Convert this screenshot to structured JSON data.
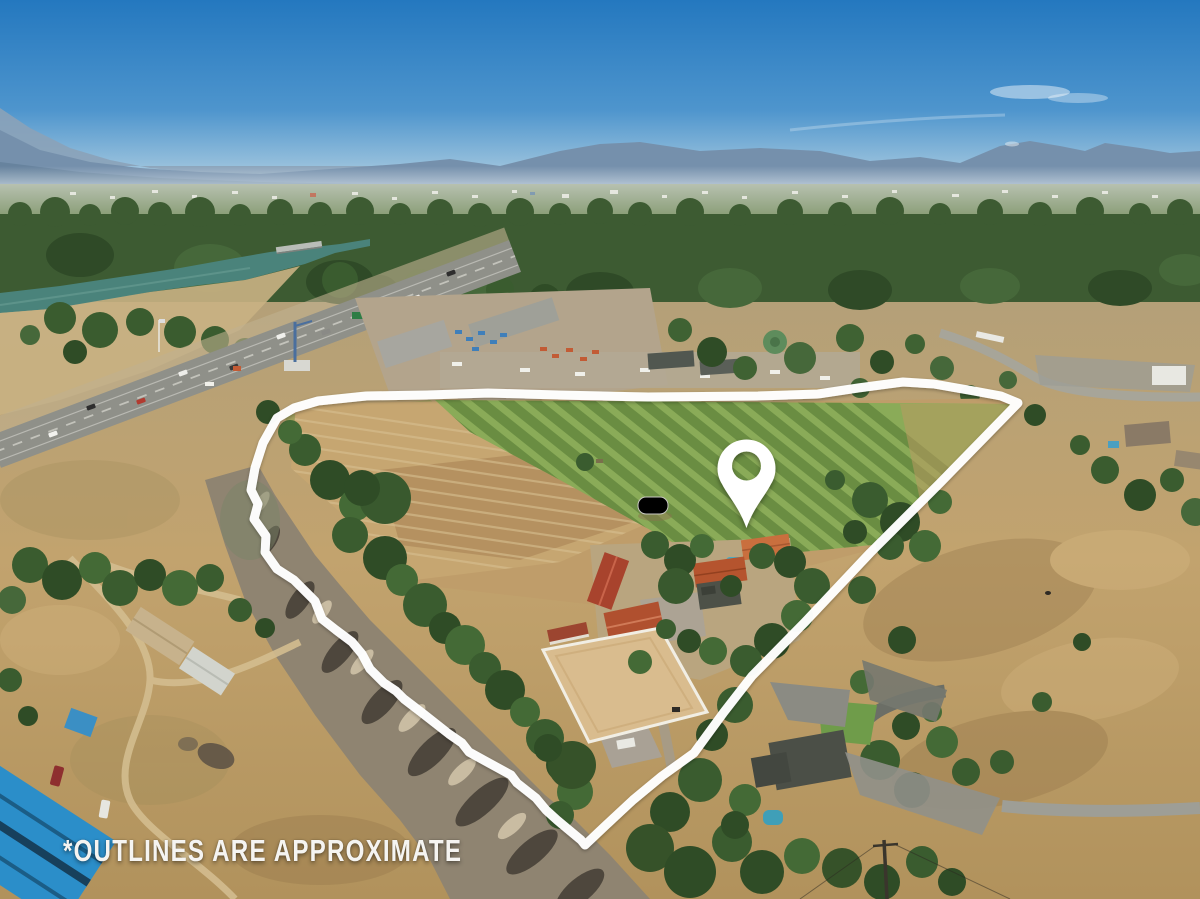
{
  "overlay": {
    "disclaimer_text": "*OUTLINES ARE APPROXIMATE",
    "pin_icon": "map-location-pin",
    "colors": {
      "property_outline": "#ffffff",
      "location_pin": "#ffffff",
      "disclaimer": "#f5f4f1"
    }
  },
  "scene": {
    "type": "aerial-real-estate-photo",
    "key_colors": {
      "sky_top": "#2478bf",
      "sky_horizon": "#cfe0ea",
      "mountains": "#7590ac",
      "tree_canopy": "#3a5c2f",
      "river_water": "#4a837b",
      "dry_grass": "#c2a36e",
      "hay_field": "#c6a671",
      "irrigated_pasture": "#86a854",
      "creek_wash": "#8f8471",
      "arena_sand": "#d9bc8e",
      "highway_asphalt": "#93948d",
      "barn_roof_red": "#a8432d",
      "blue_metal_roof": "#2b8ec9",
      "pool_water": "#3fa0b8"
    }
  }
}
